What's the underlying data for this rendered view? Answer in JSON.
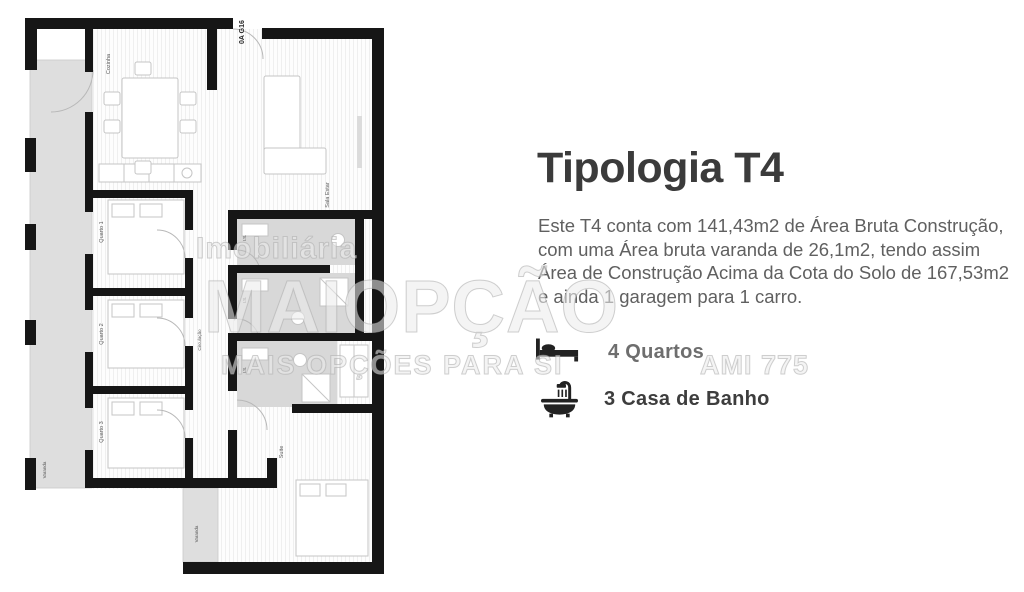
{
  "page": {
    "background": "#ffffff"
  },
  "colors": {
    "wall": "#161616",
    "balcony_gray": "#dedede",
    "bathroom_gray": "#d8d8d8",
    "furniture_stroke": "#c5c5c5",
    "label_gray": "#5a5a5a",
    "unit_label_dark": "#2a2a2a",
    "title_dark": "#3b3b3b",
    "body_gray": "#606060",
    "feature_muted": "#6e6e6e",
    "feature_dark": "#3d3d3d",
    "watermark_gray": "#bdbdbd"
  },
  "floor_plan": {
    "unit_label": "0A G16",
    "rooms": {
      "kitchen": "Cozinha",
      "living": "Sala Estar",
      "bedroom1": "Quarto 1",
      "bedroom2": "Quarto 2",
      "bedroom3": "Quarto 3",
      "corridor": "Circulação",
      "bath1": "I.S.",
      "bath2": "I.S.",
      "bath_suite": "I.S.",
      "suite": "Suite",
      "balcony_left": "Varanda",
      "balcony_bottom": "Varanda"
    }
  },
  "watermark": {
    "brand_top": "Imobiliária",
    "brand_main": "MAIOPÇÃO",
    "tagline": "MAIS OPÇÕES PARA SI",
    "license": "AMI 775"
  },
  "panel": {
    "title": "Tipologia T4",
    "description_lines": [
      "Este T4 conta com 141,43m2 de Área Bruta Construção,",
      "com uma Área bruta varanda de 26,1m2, tendo assim",
      "Área de Construção Acima da Cota do Solo de 167,53m2",
      "e ainda 1 garagem para 1 carro."
    ],
    "features": [
      {
        "icon": "bed-icon",
        "label": "4 Quartos"
      },
      {
        "icon": "bathtub-icon",
        "label": "3 Casa de Banho"
      }
    ]
  }
}
